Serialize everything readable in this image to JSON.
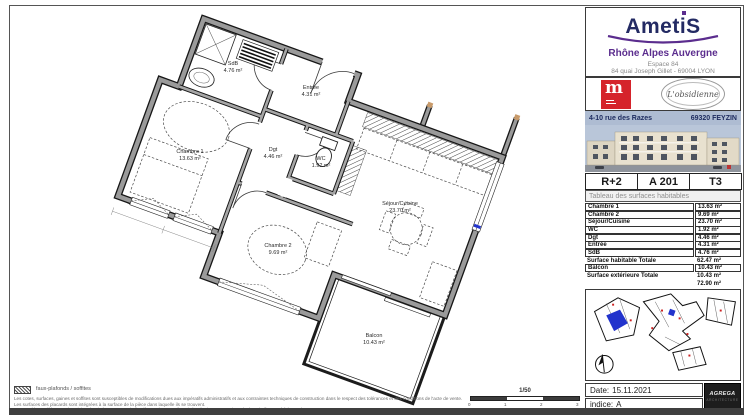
{
  "colors": {
    "wall_grey": "#9a9a9a",
    "wall_edge": "#161616",
    "brand_navy": "#232a63",
    "brand_purple": "#5b2d8e",
    "logo_red": "#d5232b",
    "band_blue": "#aebcd2",
    "plan_unit_blue": "#2233cc",
    "cap_tan": "#c89a6a"
  },
  "brand": {
    "name": "AmetiS",
    "region": "Rhône Alpes Auvergne",
    "address1": "Espace 84",
    "address2": "84 quai Joseph Gillet - 69004 LYON"
  },
  "logos": {
    "monogram": "m",
    "oval": "L'obsidienne"
  },
  "band": {
    "street": "4-10 rue des Razes",
    "city": "69320 FEYZIN"
  },
  "unit": {
    "floor": "R+2",
    "code": "A 201",
    "type": "T3"
  },
  "table": {
    "title": "Tableau des surfaces habitables",
    "rows": [
      {
        "l": "Chambre 1",
        "v": "13.63 m²"
      },
      {
        "l": "Chambre 2",
        "v": "9.69 m²"
      },
      {
        "l": "Séjour/Cuisine",
        "v": "23.70 m²"
      },
      {
        "l": "WC",
        "v": "1.92 m²"
      },
      {
        "l": "Dgt",
        "v": "4.46 m²"
      },
      {
        "l": "Entrée",
        "v": "4.31 m²"
      },
      {
        "l": "SdB",
        "v": "4.76 m²"
      }
    ],
    "total_habitable": {
      "l": "Surface habitable Totale",
      "v": "62.47 m²"
    },
    "balcon": {
      "l": "Balcon",
      "v": "10.43 m²"
    },
    "total_exterieure": {
      "l": "Surface extérieure Totale",
      "v": "10.43 m²"
    },
    "total_general": "72.90 m²"
  },
  "plan": {
    "rooms": [
      {
        "name": "SdB",
        "area": "4.76 m²"
      },
      {
        "name": "Entrée",
        "area": "4.31 m²"
      },
      {
        "name": "Dgt",
        "area": "4.46 m²"
      },
      {
        "name": "WC",
        "area": "1.92 m²"
      },
      {
        "name": "Chambre 1",
        "area": "13.63 m²"
      },
      {
        "name": "Chambre 2",
        "area": "9.69 m²"
      },
      {
        "name": "Séjour/Cuisine",
        "area": "23.70 m²"
      },
      {
        "name": "Balcon",
        "area": "10.43 m²"
      }
    ]
  },
  "legend": {
    "label": "faux-plafonds / soffites"
  },
  "disclaimers": [
    "Les cotes, surfaces, gaines et soffites sont susceptibles de modifications dues aux impératifs administratifs et aux contraintes techniques de construction dans le respect des tolérances et des conditions de l'acte de vente.",
    "Les surfaces des placards sont intégrées à la surface de la pièce dans laquelle ils se trouvent.",
    "Les meubles et éléments de cuisine dessinés ne sont qu'indicatifs. Seuls seront fournis les équipements suivant le descriptif annexé à l'acte de vente."
  ],
  "scale": {
    "label": "1/50",
    "t0": "0",
    "t1": "1",
    "t2": "2",
    "t3": "3"
  },
  "footer": {
    "date_label": "Date:",
    "date": "15.11.2021",
    "indice_label": "indice:",
    "indice": "A"
  },
  "architect": {
    "name": "AGREGA",
    "sub": "ARCHITECTURE"
  }
}
